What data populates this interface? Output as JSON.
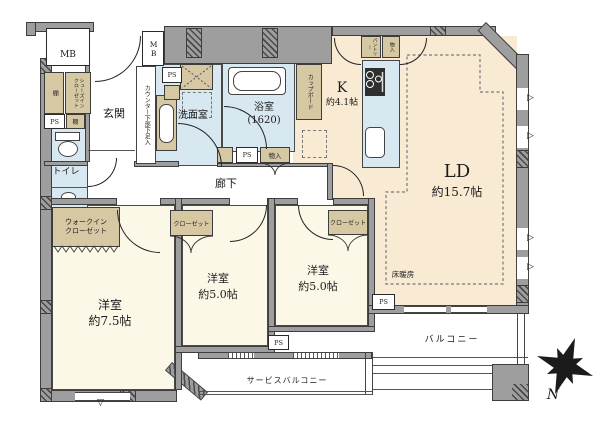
{
  "colors": {
    "wall": "#9e9e9e",
    "wall_line": "#3d3d3d",
    "ldk_fill": "#f9ead3",
    "bedroom_fill": "#fbf8e8",
    "wet_fill": "#d7e8f1",
    "closet_fill": "#d5c8a2"
  },
  "rooms": {
    "ld": {
      "label": "LD",
      "size": "約15.7帖"
    },
    "kitchen": {
      "label": "K",
      "size": "約4.1帖"
    },
    "bathroom": {
      "label": "浴室",
      "size": "(1620)"
    },
    "washroom": {
      "label": "洗面室"
    },
    "toilet": {
      "label": "トイレ"
    },
    "entrance": {
      "label": "玄関"
    },
    "corridor": {
      "label": "廊下"
    },
    "bedroom1": {
      "label": "洋室",
      "size": "約7.5帖"
    },
    "bedroom2": {
      "label": "洋室",
      "size": "約5.0帖"
    },
    "bedroom3": {
      "label": "洋室",
      "size": "約5.0帖"
    },
    "balcony": {
      "label": "バルコニー"
    },
    "service_balcony": {
      "label": "サービスバルコニー"
    }
  },
  "storage": {
    "walk_in_closet": "ウォークイン\nクローゼット",
    "shoes_in_closet": "シューズイン\nクローゼット",
    "closet_bedroom2": "クローゼット",
    "closet_bedroom3": "クローゼット",
    "cupboard": "カップボード",
    "pantry": "パントリー",
    "storage_kitchen": "物入",
    "storage_corridor": "物入",
    "shelf_upper": "棚",
    "shelf_lower": "棚"
  },
  "labels": {
    "pipe_space": "PS",
    "meter_box": "MB",
    "counter_shoe_storage": "カウンター下部下足入",
    "floor_heating": "床暖房",
    "compass_north": "N"
  },
  "icons": {
    "window_marker_right": "▷",
    "window_marker_down": "▽"
  }
}
